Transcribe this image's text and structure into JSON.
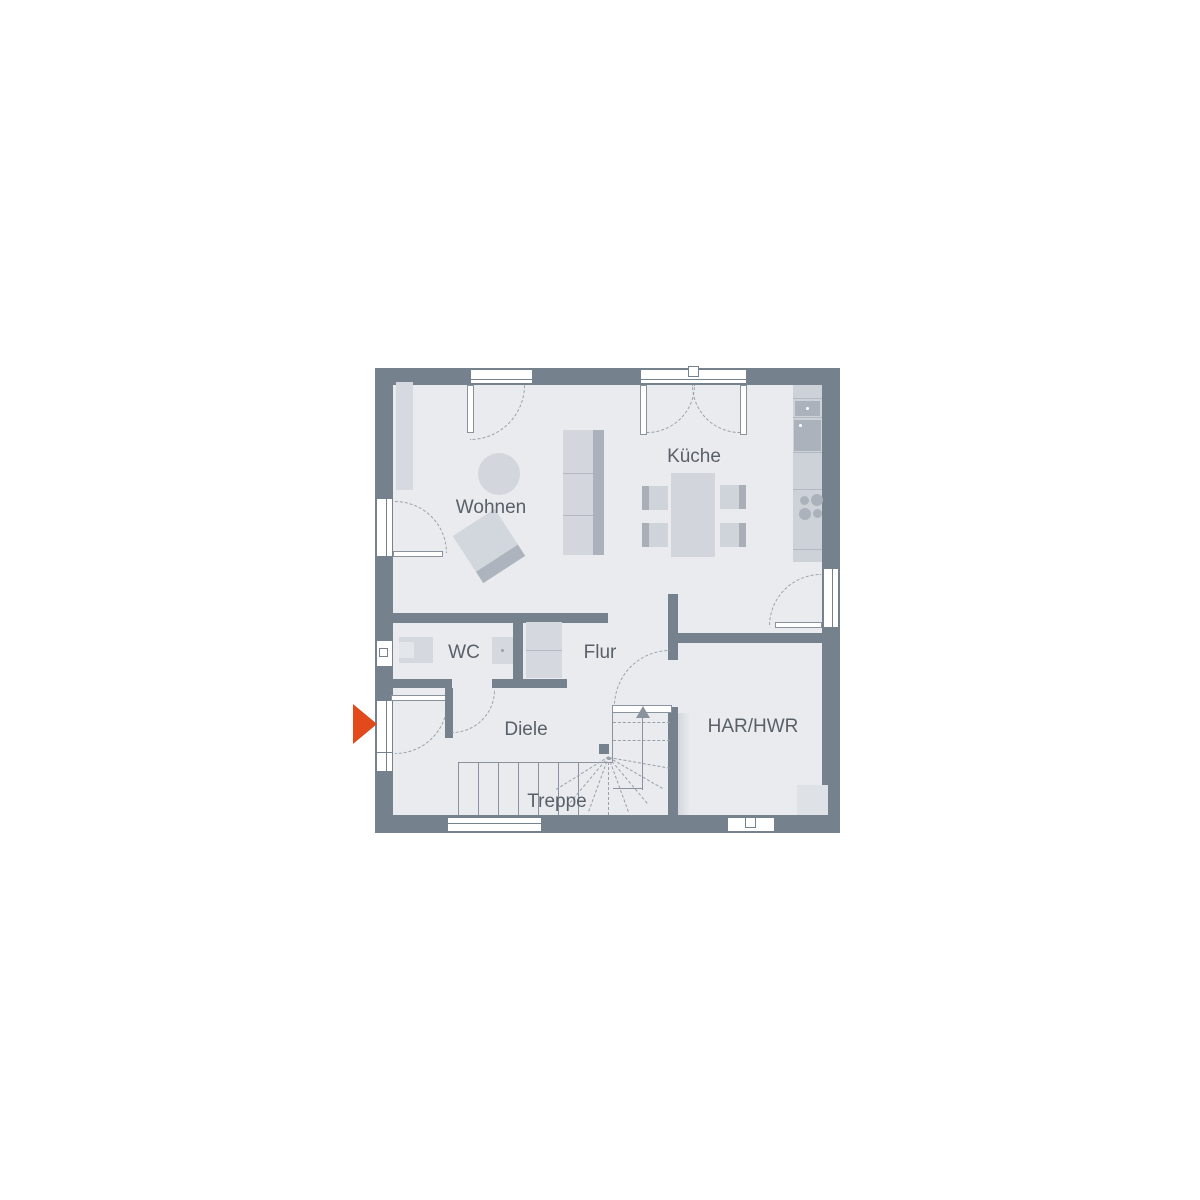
{
  "plan": {
    "type": "floor-plan",
    "rooms": [
      {
        "label": "Wohnen"
      },
      {
        "label": "Küche"
      },
      {
        "label": "WC"
      },
      {
        "label": "Flur"
      },
      {
        "label": "Diele"
      },
      {
        "label": "Treppe"
      },
      {
        "label": "HAR/HWR"
      }
    ],
    "entrance": {
      "marker": "entrance-arrow",
      "direction": "right",
      "color": "#E2491B"
    },
    "colors": {
      "wall": "#76818E",
      "floor": "#E9EBEE",
      "furnitureLight": "#D3D7DD",
      "furnitureMid": "#ACB2BB",
      "line": "#8A929D",
      "dash": "#98A0AB",
      "label": "#5A6069",
      "background": "#FFFFFF",
      "arrow": "#E2491B"
    }
  }
}
